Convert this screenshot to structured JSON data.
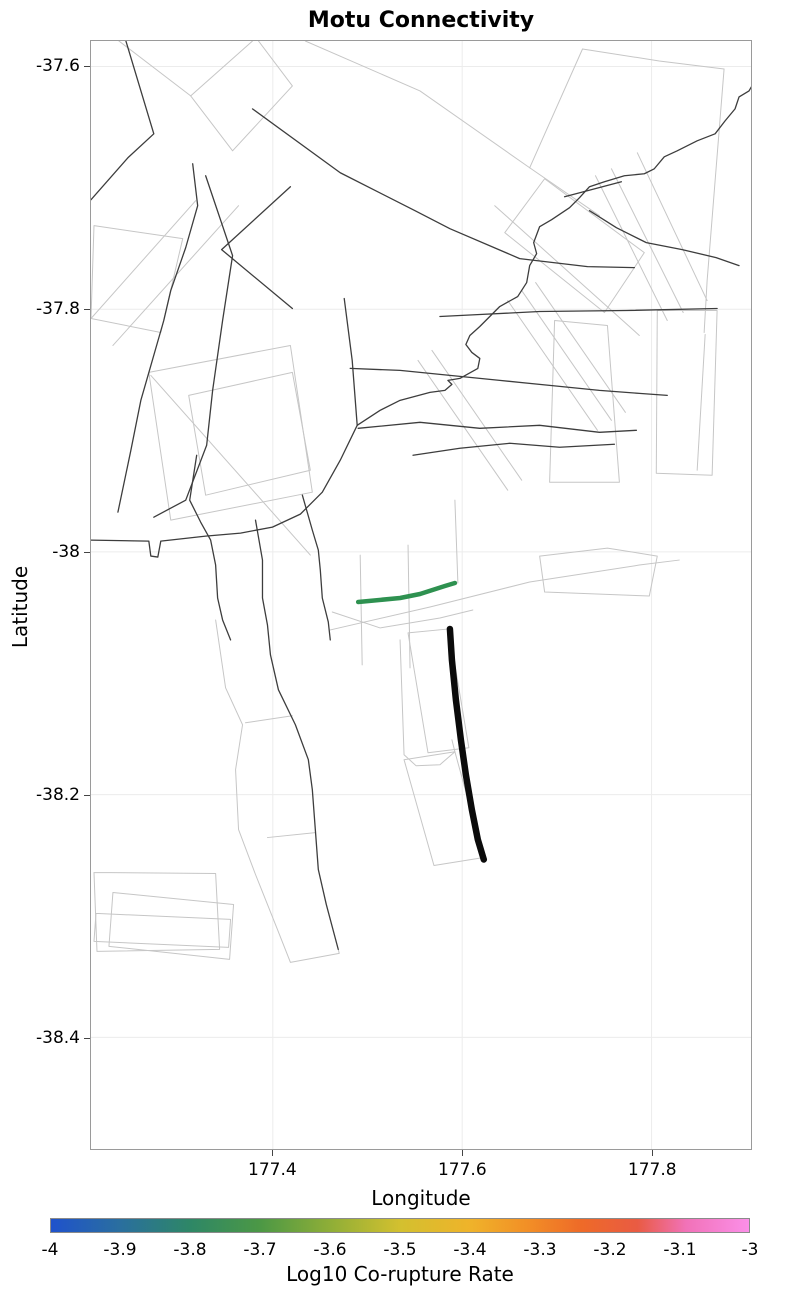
{
  "title": "Motu Connectivity",
  "axes": {
    "x": {
      "label": "Longitude",
      "range": [
        177.208,
        177.905
      ],
      "ticks": [
        177.4,
        177.6,
        177.8
      ],
      "tick_labels": [
        "177.4",
        "177.6",
        "177.8"
      ]
    },
    "y": {
      "label": "Latitude",
      "range": [
        -38.492,
        -37.579
      ],
      "ticks": [
        -37.6,
        -37.8,
        -38.0,
        -38.2,
        -38.4
      ],
      "tick_labels": [
        "-37.6",
        "-37.8",
        "-38",
        "-38.2",
        "-38.4"
      ]
    }
  },
  "colorbar": {
    "label": "Log10 Co-rupture Rate",
    "min": -4,
    "max": -3,
    "tick_labels": [
      "-4",
      "-3.9",
      "-3.8",
      "-3.7",
      "-3.6",
      "-3.5",
      "-3.4",
      "-3.3",
      "-3.2",
      "-3.1",
      "-3"
    ],
    "gradient": [
      [
        "0%",
        "#1f52cc"
      ],
      [
        "10%",
        "#2a6f9e"
      ],
      [
        "20%",
        "#2e8766"
      ],
      [
        "30%",
        "#4c9845"
      ],
      [
        "40%",
        "#8fae37"
      ],
      [
        "50%",
        "#d3c02f"
      ],
      [
        "60%",
        "#efb32a"
      ],
      [
        "68%",
        "#f29026"
      ],
      [
        "76%",
        "#ee6a28"
      ],
      [
        "84%",
        "#e95b43"
      ],
      [
        "91%",
        "#f172b8"
      ],
      [
        "100%",
        "#fb8fe8"
      ]
    ]
  },
  "chart_data": {
    "type": "line",
    "title": "Motu Connectivity",
    "xlabel": "Longitude",
    "ylabel": "Latitude",
    "xlim": [
      177.208,
      177.905
    ],
    "ylim": [
      -38.492,
      -37.579
    ],
    "grid": true,
    "legend": "none",
    "colorbar_label": "Log10 Co-rupture Rate",
    "colorbar_range": [
      -4,
      -3
    ],
    "description": "Fault network map: thin dark lines are fault traces, light gray polygons are fault surface projections, thick black line is the Motu source fault, green line is a connected fault colored by log10 co-rupture rate.",
    "highlighted_segments": [
      {
        "name": "co-rupture-fault-green",
        "color": "#2e9150",
        "log10_rate_estimate": -3.8,
        "coords_lonlat": [
          [
            177.49,
            -38.041
          ],
          [
            177.534,
            -38.038
          ],
          [
            177.555,
            -38.035
          ],
          [
            177.581,
            -38.028
          ],
          [
            177.592,
            -38.026
          ]
        ]
      },
      {
        "name": "motu-source-fault-black",
        "color": "#000000",
        "coords_lonlat": [
          [
            177.587,
            -38.063
          ],
          [
            177.589,
            -38.089
          ],
          [
            177.593,
            -38.122
          ],
          [
            177.598,
            -38.155
          ],
          [
            177.604,
            -38.183
          ],
          [
            177.61,
            -38.212
          ],
          [
            177.617,
            -38.237
          ],
          [
            177.623,
            -38.253
          ]
        ]
      }
    ]
  },
  "map_layers": {
    "plot_px": {
      "w": 662,
      "h": 1110
    },
    "frame_color": "#9a9a9a",
    "gridline_color": "#ececec",
    "trace_color": "#3d3d3d",
    "trace_width": 1.3,
    "outline_color": "#c6c6c6",
    "outline_width": 1,
    "traces": [
      [
        [
          35,
          0
        ],
        [
          63,
          93
        ],
        [
          37,
          117
        ],
        [
          0,
          159
        ]
      ],
      [
        [
          102,
          123
        ],
        [
          107,
          165
        ],
        [
          95,
          207
        ],
        [
          80,
          250
        ],
        [
          73,
          280
        ],
        [
          50,
          360
        ],
        [
          40,
          410
        ],
        [
          27,
          472
        ]
      ],
      [
        [
          115,
          135
        ],
        [
          142,
          215
        ],
        [
          132,
          280
        ],
        [
          122,
          350
        ],
        [
          116,
          405
        ],
        [
          95,
          460
        ],
        [
          63,
          477
        ]
      ],
      [
        [
          200,
          146
        ],
        [
          131,
          209
        ],
        [
          202,
          268
        ]
      ],
      [
        [
          162,
          68
        ],
        [
          250,
          132
        ],
        [
          325,
          170
        ],
        [
          360,
          188
        ],
        [
          430,
          218
        ],
        [
          498,
          226
        ],
        [
          545,
          227
        ]
      ],
      [
        [
          475,
          156
        ],
        [
          532,
          141
        ]
      ],
      [
        [
          500,
          170
        ],
        [
          527,
          187
        ],
        [
          557,
          202
        ],
        [
          593,
          209
        ],
        [
          627,
          217
        ],
        [
          650,
          225
        ]
      ],
      [
        [
          350,
          276
        ],
        [
          390,
          274
        ],
        [
          450,
          271
        ],
        [
          537,
          270
        ],
        [
          628,
          268
        ]
      ],
      [
        [
          267,
          385
        ],
        [
          290,
          370
        ],
        [
          310,
          360
        ],
        [
          340,
          352
        ],
        [
          355,
          350
        ],
        [
          362,
          344
        ],
        [
          358,
          340
        ],
        [
          370,
          338
        ],
        [
          388,
          328
        ],
        [
          390,
          318
        ],
        [
          382,
          312
        ],
        [
          376,
          304
        ],
        [
          380,
          295
        ],
        [
          390,
          286
        ],
        [
          410,
          266
        ],
        [
          428,
          256
        ],
        [
          437,
          242
        ],
        [
          440,
          225
        ],
        [
          447,
          213
        ],
        [
          444,
          202
        ],
        [
          450,
          186
        ],
        [
          462,
          179
        ],
        [
          480,
          167
        ],
        [
          490,
          157
        ],
        [
          500,
          146
        ],
        [
          515,
          141
        ],
        [
          535,
          135
        ],
        [
          555,
          133
        ],
        [
          565,
          128
        ],
        [
          575,
          116
        ],
        [
          588,
          110
        ],
        [
          608,
          100
        ],
        [
          626,
          93
        ],
        [
          636,
          80
        ],
        [
          646,
          68
        ],
        [
          650,
          56
        ],
        [
          660,
          50
        ],
        [
          667,
          38
        ],
        [
          668,
          25
        ]
      ],
      [
        [
          0,
          500
        ],
        [
          58,
          501
        ],
        [
          60,
          516
        ],
        [
          67,
          517
        ],
        [
          70,
          501
        ],
        [
          115,
          496
        ],
        [
          150,
          493
        ],
        [
          182,
          487
        ],
        [
          210,
          474
        ],
        [
          232,
          452
        ],
        [
          250,
          420
        ],
        [
          267,
          385
        ]
      ],
      [
        [
          254,
          258
        ],
        [
          262,
          320
        ],
        [
          267,
          385
        ]
      ],
      [
        [
          260,
          328
        ],
        [
          310,
          330
        ],
        [
          360,
          335
        ],
        [
          410,
          340
        ],
        [
          460,
          345
        ],
        [
          510,
          350
        ],
        [
          550,
          353
        ],
        [
          578,
          355
        ]
      ],
      [
        [
          268,
          388
        ],
        [
          330,
          382
        ],
        [
          390,
          388
        ],
        [
          450,
          385
        ],
        [
          510,
          392
        ],
        [
          547,
          390
        ]
      ],
      [
        [
          323,
          415
        ],
        [
          370,
          408
        ],
        [
          420,
          403
        ],
        [
          470,
          407
        ],
        [
          525,
          404
        ]
      ],
      [
        [
          106,
          415
        ],
        [
          99,
          460
        ],
        [
          110,
          482
        ],
        [
          120,
          500
        ],
        [
          125,
          525
        ],
        [
          127,
          558
        ],
        [
          132,
          580
        ],
        [
          140,
          600
        ]
      ],
      [
        [
          165,
          480
        ],
        [
          172,
          520
        ],
        [
          172,
          558
        ],
        [
          177,
          585
        ],
        [
          180,
          615
        ],
        [
          188,
          650
        ],
        [
          205,
          685
        ],
        [
          218,
          720
        ],
        [
          222,
          750
        ],
        [
          225,
          790
        ],
        [
          228,
          830
        ],
        [
          236,
          865
        ],
        [
          248,
          910
        ]
      ],
      [
        [
          212,
          455
        ],
        [
          222,
          490
        ],
        [
          228,
          510
        ],
        [
          230,
          530
        ],
        [
          232,
          558
        ],
        [
          238,
          582
        ],
        [
          240,
          600
        ]
      ]
    ],
    "outlines": [
      [
        [
          28,
          0
        ],
        [
          100,
          55
        ],
        [
          162,
          0
        ]
      ],
      [
        [
          100,
          55
        ],
        [
          142,
          110
        ],
        [
          202,
          45
        ],
        [
          168,
          0
        ]
      ],
      [
        [
          215,
          0
        ],
        [
          330,
          50
        ],
        [
          440,
          127
        ],
        [
          510,
          175
        ]
      ],
      [
        [
          493,
          8
        ],
        [
          440,
          127
        ]
      ],
      [
        [
          493,
          8
        ],
        [
          570,
          20
        ],
        [
          635,
          28
        ],
        [
          626,
          140
        ],
        [
          618,
          240
        ],
        [
          615,
          292
        ]
      ],
      [
        [
          506,
          135
        ],
        [
          578,
          280
        ]
      ],
      [
        [
          522,
          128
        ],
        [
          594,
          272
        ]
      ],
      [
        [
          548,
          112
        ],
        [
          618,
          260
        ]
      ],
      [
        [
          415,
          192
        ],
        [
          455,
          138
        ],
        [
          555,
          212
        ],
        [
          515,
          272
        ],
        [
          415,
          192
        ]
      ],
      [
        [
          405,
          165
        ],
        [
          550,
          295
        ]
      ],
      [
        [
          3,
          185
        ],
        [
          92,
          198
        ],
        [
          70,
          292
        ],
        [
          0,
          278
        ],
        [
          3,
          185
        ]
      ],
      [
        [
          0,
          278
        ],
        [
          105,
          160
        ]
      ],
      [
        [
          22,
          305
        ],
        [
          148,
          165
        ]
      ],
      [
        [
          58,
          332
        ],
        [
          200,
          305
        ],
        [
          222,
          452
        ],
        [
          80,
          480
        ],
        [
          58,
          332
        ]
      ],
      [
        [
          98,
          355
        ],
        [
          202,
          332
        ],
        [
          220,
          430
        ],
        [
          115,
          455
        ],
        [
          98,
          355
        ]
      ],
      [
        [
          60,
          335
        ],
        [
          220,
          515
        ]
      ],
      [
        [
          125,
          580
        ],
        [
          135,
          648
        ],
        [
          152,
          685
        ],
        [
          145,
          730
        ],
        [
          148,
          790
        ],
        [
          165,
          835
        ],
        [
          187,
          890
        ],
        [
          200,
          923
        ],
        [
          249,
          914
        ],
        [
          248,
          910
        ]
      ],
      [
        [
          155,
          683
        ],
        [
          202,
          676
        ]
      ],
      [
        [
          177,
          798
        ],
        [
          225,
          793
        ]
      ],
      [
        [
          3,
          833
        ],
        [
          125,
          834
        ],
        [
          129,
          910
        ],
        [
          6,
          912
        ],
        [
          3,
          833
        ]
      ],
      [
        [
          22,
          853
        ],
        [
          143,
          865
        ],
        [
          139,
          920
        ],
        [
          18,
          907
        ],
        [
          22,
          853
        ]
      ],
      [
        [
          5,
          874
        ],
        [
          140,
          880
        ],
        [
          138,
          908
        ],
        [
          3,
          902
        ],
        [
          5,
          874
        ]
      ],
      [
        [
          318,
          593
        ],
        [
          359,
          589
        ],
        [
          379,
          708
        ],
        [
          338,
          713
        ],
        [
          318,
          593
        ]
      ],
      [
        [
          310,
          600
        ],
        [
          314,
          715
        ],
        [
          326,
          726
        ],
        [
          350,
          725
        ],
        [
          365,
          712
        ],
        [
          362,
          700
        ]
      ],
      [
        [
          314,
          720
        ],
        [
          365,
          712
        ],
        [
          394,
          818
        ],
        [
          344,
          826
        ],
        [
          314,
          720
        ]
      ],
      [
        [
          568,
          270
        ],
        [
          628,
          270
        ],
        [
          623,
          435
        ],
        [
          567,
          433
        ],
        [
          568,
          270
        ]
      ],
      [
        [
          465,
          280
        ],
        [
          518,
          285
        ],
        [
          530,
          442
        ],
        [
          460,
          442
        ],
        [
          465,
          280
        ]
      ],
      [
        [
          450,
          516
        ],
        [
          518,
          508
        ],
        [
          568,
          516
        ],
        [
          560,
          556
        ],
        [
          455,
          552
        ],
        [
          450,
          516
        ]
      ],
      [
        [
          616,
          294
        ],
        [
          608,
          430
        ]
      ],
      [
        [
          432,
          250
        ],
        [
          522,
          380
        ]
      ],
      [
        [
          418,
          260
        ],
        [
          508,
          390
        ]
      ],
      [
        [
          446,
          242
        ],
        [
          536,
          372
        ]
      ],
      [
        [
          342,
          310
        ],
        [
          432,
          440
        ]
      ],
      [
        [
          328,
          320
        ],
        [
          418,
          450
        ]
      ],
      [
        [
          270,
          515
        ],
        [
          272,
          625
        ]
      ],
      [
        [
          318,
          505
        ],
        [
          320,
          628
        ]
      ],
      [
        [
          365,
          460
        ],
        [
          368,
          543
        ]
      ],
      [
        [
          240,
          590
        ],
        [
          340,
          567
        ],
        [
          440,
          542
        ],
        [
          550,
          525
        ],
        [
          590,
          520
        ]
      ],
      [
        [
          242,
          572
        ],
        [
          290,
          588
        ],
        [
          350,
          578
        ],
        [
          383,
          570
        ]
      ]
    ],
    "green_line": {
      "color": "#2e9150",
      "width": 4.5,
      "points": [
        [
          268,
          562
        ],
        [
          310,
          558
        ],
        [
          330,
          554
        ],
        [
          355,
          546
        ],
        [
          365,
          543
        ]
      ]
    },
    "black_line": {
      "color": "#0b0b0b",
      "width": 6.5,
      "points": [
        [
          360,
          589
        ],
        [
          362,
          620
        ],
        [
          366,
          660
        ],
        [
          371,
          700
        ],
        [
          376,
          735
        ],
        [
          382,
          770
        ],
        [
          388,
          800
        ],
        [
          394,
          820
        ]
      ]
    }
  }
}
